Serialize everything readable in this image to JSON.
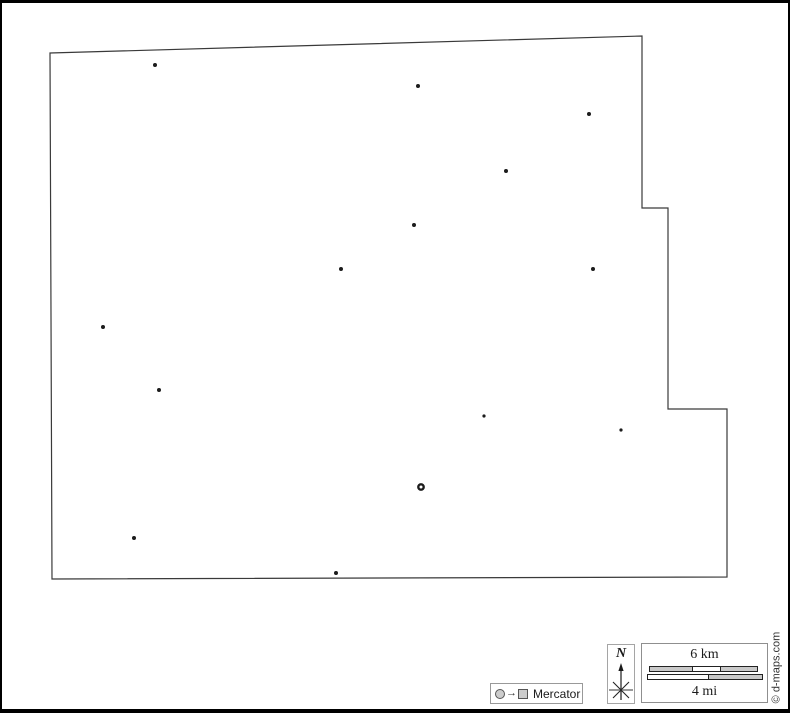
{
  "canvas": {
    "width": 790,
    "height": 713,
    "background": "#ffffff",
    "frame_color": "#000000"
  },
  "map": {
    "kind": "blank-outline-county-map",
    "outline_color": "#3a3a3a",
    "fill_color": "#ffffff",
    "marker_color": "#1c1c1c",
    "outline": [
      [
        50,
        53
      ],
      [
        642,
        36
      ],
      [
        642,
        208
      ],
      [
        668,
        208
      ],
      [
        668,
        409
      ],
      [
        727,
        409
      ],
      [
        727,
        577
      ],
      [
        52,
        579
      ]
    ],
    "markers": [
      {
        "x": 155,
        "y": 65,
        "r": 2,
        "type": "dot"
      },
      {
        "x": 418,
        "y": 86,
        "r": 2,
        "type": "dot"
      },
      {
        "x": 589,
        "y": 114,
        "r": 2,
        "type": "dot"
      },
      {
        "x": 506,
        "y": 171,
        "r": 2,
        "type": "dot"
      },
      {
        "x": 414,
        "y": 225,
        "r": 2,
        "type": "dot"
      },
      {
        "x": 341,
        "y": 269,
        "r": 2,
        "type": "dot"
      },
      {
        "x": 593,
        "y": 269,
        "r": 2,
        "type": "dot"
      },
      {
        "x": 103,
        "y": 327,
        "r": 2,
        "type": "dot"
      },
      {
        "x": 159,
        "y": 390,
        "r": 2,
        "type": "dot"
      },
      {
        "x": 484,
        "y": 416,
        "r": 1.6,
        "type": "dot"
      },
      {
        "x": 621,
        "y": 430,
        "r": 1.6,
        "type": "dot"
      },
      {
        "x": 421,
        "y": 487,
        "r": 2.7,
        "type": "ring"
      },
      {
        "x": 134,
        "y": 538,
        "r": 2,
        "type": "dot"
      },
      {
        "x": 336,
        "y": 573,
        "r": 2,
        "type": "dot"
      }
    ]
  },
  "legend": {
    "projection": "Mercator",
    "arrow_glyph": "→"
  },
  "compass": {
    "label": "N"
  },
  "scalebar": {
    "km_label": "6 km",
    "mi_label": "4 mi"
  },
  "copyright": {
    "text": "© d-maps.com"
  },
  "colors": {
    "frame": "#000000",
    "map_outline": "#3a3a3a",
    "marker": "#1c1c1c",
    "box_border": "#999999",
    "bar_gray": "#c9c9c9",
    "bar_outline": "#222222",
    "symbol_fill": "#cccccc",
    "symbol_stroke": "#555555",
    "text": "#1a1a1a"
  }
}
